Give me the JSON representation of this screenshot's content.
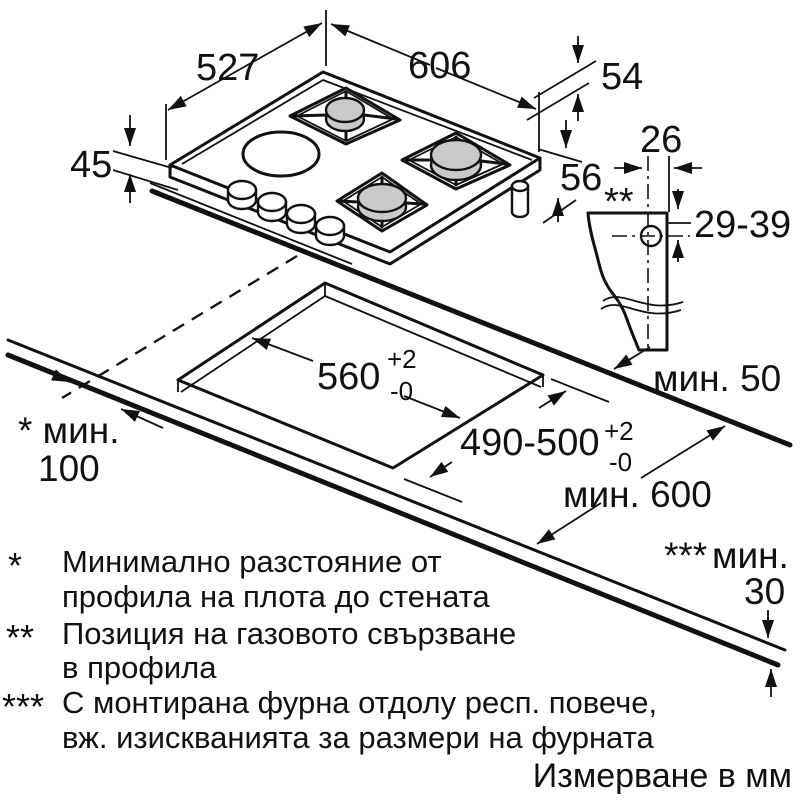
{
  "dims": {
    "hob_depth": "527",
    "hob_width": "606",
    "hob_height": "45",
    "profile_front": "54",
    "profile_connection": "56",
    "conn_width": "26",
    "conn_range": "29-39",
    "gas_marker": "**",
    "min_right": "мин. 50",
    "min_left_label": "* мин.",
    "min_left_value": "100",
    "cutout_w": "560",
    "cutout_w_plus": "+2",
    "cutout_w_minus": "-0",
    "cutout_d": "490-500",
    "cutout_d_plus": "+2",
    "cutout_d_minus": "-0",
    "min_depth": "мин. 600",
    "thick_marker": "***",
    "thick_label": "мин.",
    "thick_value": "30"
  },
  "footnotes": [
    {
      "marker": "*",
      "line1": "Минимално разстояние от",
      "line2": "профила на плота до стената"
    },
    {
      "marker": "**",
      "line1": "Позиция на газовото свързване",
      "line2": "в профила"
    },
    {
      "marker": "***",
      "line1": "С монтирана фурна отдолу респ. повече,",
      "line2": "вж. изискванията за размери на фурната"
    }
  ],
  "units_note": "Измерване в мм",
  "colors": {
    "line": "#111111",
    "burner_cap": "#c9c9c9",
    "background": "#ffffff"
  }
}
